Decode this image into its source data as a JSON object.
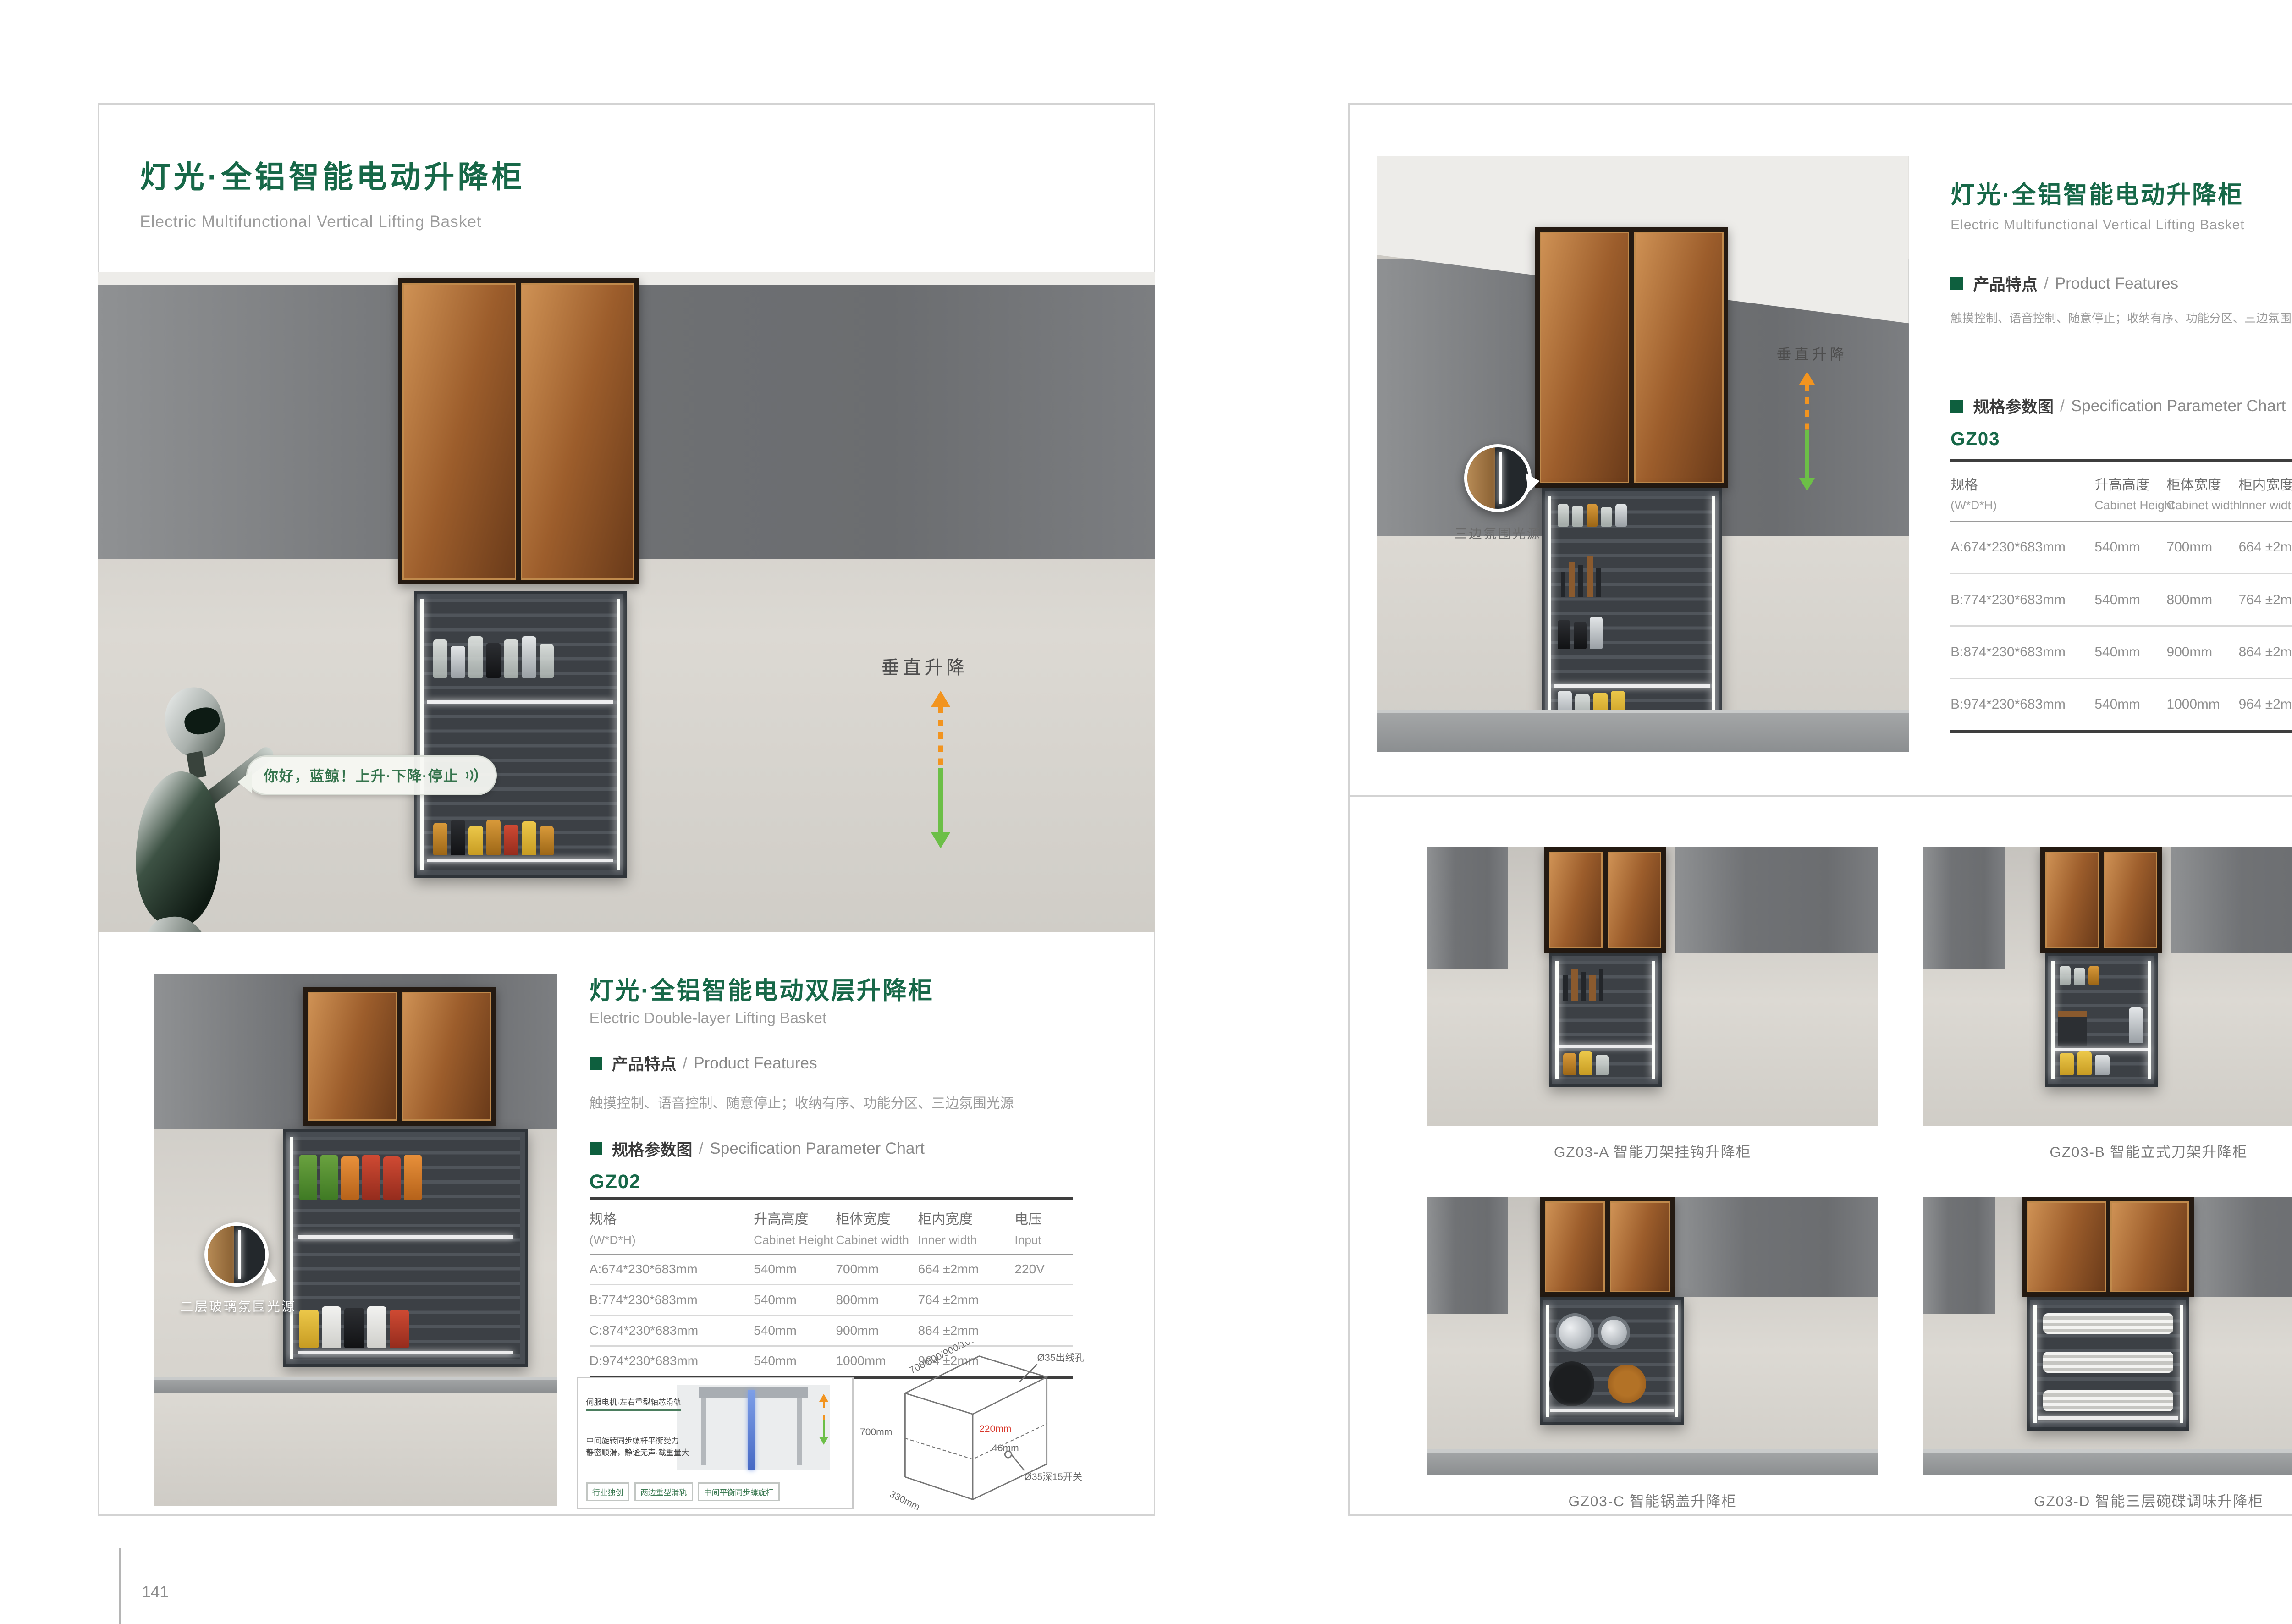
{
  "ui": {
    "sep": "/"
  },
  "colors": {
    "brand_green": "#176848",
    "bullet_green": "#0e5f3e",
    "arrow_orange": "#f2941f",
    "arrow_green": "#6cbf47",
    "dim_red": "#d8372b"
  },
  "icons": {
    "voice_wave": "three concentric arcs (sound waves)",
    "arrow_up_dashed": "orange dashed up arrow",
    "arrow_down_solid": "green solid down arrow",
    "magnifier_callout": "circular zoom detail bubble",
    "green_square_bullet": "solid green square"
  },
  "page_left": {
    "page_number": "141",
    "title": "灯光·全铝智能电动升降柜",
    "subtitle": "Electric Multifunctional Vertical Lifting Basket",
    "hero": {
      "speech_text": "你好，蓝鲸！上升·下降·停止",
      "lift_label": "垂直升降"
    },
    "section": {
      "title": "灯光·全铝智能电动双层升降柜",
      "subtitle": "Electric Double-layer Lifting Basket",
      "features_heading_cn": "产品特点",
      "features_heading_en": "Product Features",
      "features_text": "触摸控制、语音控制、随意停止；收纳有序、功能分区、三边氛围光源",
      "spec_heading_cn": "规格参数图",
      "spec_heading_en": "Specification Parameter Chart",
      "model": "GZ02",
      "photo_callout": "二层玻璃氛围光源",
      "table": {
        "headers": [
          {
            "cn": "规格",
            "en": "(W*D*H)"
          },
          {
            "cn": "升高高度",
            "en": "Cabinet Height"
          },
          {
            "cn": "柜体宽度",
            "en": "Cabinet width"
          },
          {
            "cn": "柜内宽度",
            "en": "Inner width"
          },
          {
            "cn": "电压",
            "en": "Input"
          }
        ],
        "rows": [
          [
            "A:674*230*683mm",
            "540mm",
            "700mm",
            "664 ±2mm",
            "220V"
          ],
          [
            "B:774*230*683mm",
            "540mm",
            "800mm",
            "764 ±2mm",
            ""
          ],
          [
            "C:874*230*683mm",
            "540mm",
            "900mm",
            "864 ±2mm",
            ""
          ],
          [
            "D:974*230*683mm",
            "540mm",
            "1000mm",
            "964 ±2mm",
            ""
          ]
        ]
      },
      "mechanism": {
        "label_top": "伺服电机·左右重型轴芯滑轨",
        "label_bottom1": "中间旋转同步螺杆平衡受力",
        "label_bottom2": "静密顺滑，静谧无声·载重量大",
        "badges": [
          "行业独创",
          "两边重型滑轨",
          "中间平衡同步螺旋杆"
        ]
      },
      "drawing": {
        "dim_top": "700/800/900/1000mm",
        "dim_hole": "Ø35出线孔",
        "dim_height": "700mm",
        "dim_depth_red": "220mm",
        "dim_46": "46mm",
        "dim_switch": "Ø35深15开关",
        "dim_bottom": "330mm"
      }
    }
  },
  "page_right": {
    "page_number": "142",
    "title": "灯光·全铝智能电动升降柜",
    "subtitle": "Electric Multifunctional Vertical Lifting Basket",
    "features_heading_cn": "产品特点",
    "features_heading_en": "Product Features",
    "features_text": "触摸控制、语音控制、随意停止；收纳有序、功能分区、三边氛围光源",
    "spec_heading_cn": "规格参数图",
    "spec_heading_en": "Specification Parameter Chart",
    "model": "GZ03",
    "photo_callout": "三边氛围光源",
    "lift_label": "垂直升降",
    "table": {
      "headers": [
        {
          "cn": "规格",
          "en": "(W*D*H)"
        },
        {
          "cn": "升高高度",
          "en": "Cabinet Height"
        },
        {
          "cn": "柜体宽度",
          "en": "Cabinet width"
        },
        {
          "cn": "柜内宽度",
          "en": "Inner width"
        },
        {
          "cn": "电压",
          "en": "Input"
        }
      ],
      "rows": [
        [
          "A:674*230*683mm",
          "540mm",
          "700mm",
          "664 ±2mm",
          "220V"
        ],
        [
          "B:774*230*683mm",
          "540mm",
          "800mm",
          "764 ±2mm",
          ""
        ],
        [
          "B:874*230*683mm",
          "540mm",
          "900mm",
          "864 ±2mm",
          ""
        ],
        [
          "B:974*230*683mm",
          "540mm",
          "1000mm",
          "964 ±2mm",
          ""
        ]
      ]
    },
    "gallery": [
      {
        "caption": "GZ03-A  智能刀架挂钩升降柜"
      },
      {
        "caption": "GZ03-B  智能立式刀架升降柜"
      },
      {
        "caption": "GZ03-C  智能锅盖升降柜"
      },
      {
        "caption": "GZ03-D  智能三层碗碟调味升降柜"
      }
    ]
  }
}
